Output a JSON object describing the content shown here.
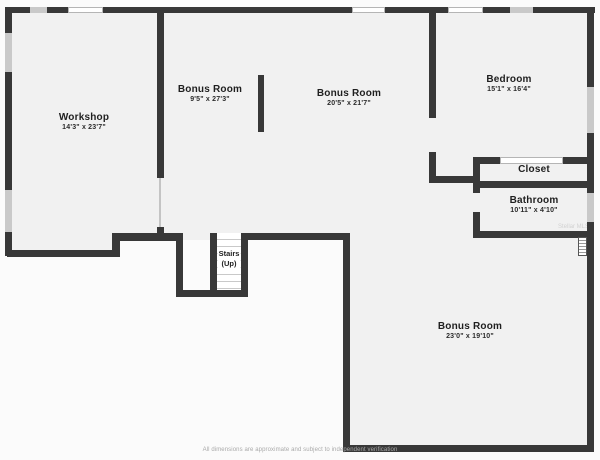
{
  "colors": {
    "wall": "#383838",
    "floor": "#f1f1f1",
    "page": "#fbfbfb",
    "window": "#c9c9c9"
  },
  "rooms": {
    "workshop": {
      "name": "Workshop",
      "dims": "14'3\" x 23'7\""
    },
    "bonus_top": {
      "name": "Bonus Room",
      "dims": "9'5\" x 27'3\""
    },
    "bonus_mid": {
      "name": "Bonus Room",
      "dims": "20'5\" x 21'7\""
    },
    "bedroom": {
      "name": "Bedroom",
      "dims": "15'1\" x 16'4\""
    },
    "closet": {
      "name": "Closet"
    },
    "bathroom": {
      "name": "Bathroom",
      "dims": "10'11\" x 4'10\""
    },
    "bonus_bottom": {
      "name": "Bonus Room",
      "dims": "23'0\" x 19'10\""
    }
  },
  "stairs": {
    "label_line1": "Stairs",
    "label_line2": "(Up)"
  },
  "footer": {
    "disclaimer": "All dimensions are approximate and subject to independent verification"
  },
  "watermark": "Stellar MLS"
}
